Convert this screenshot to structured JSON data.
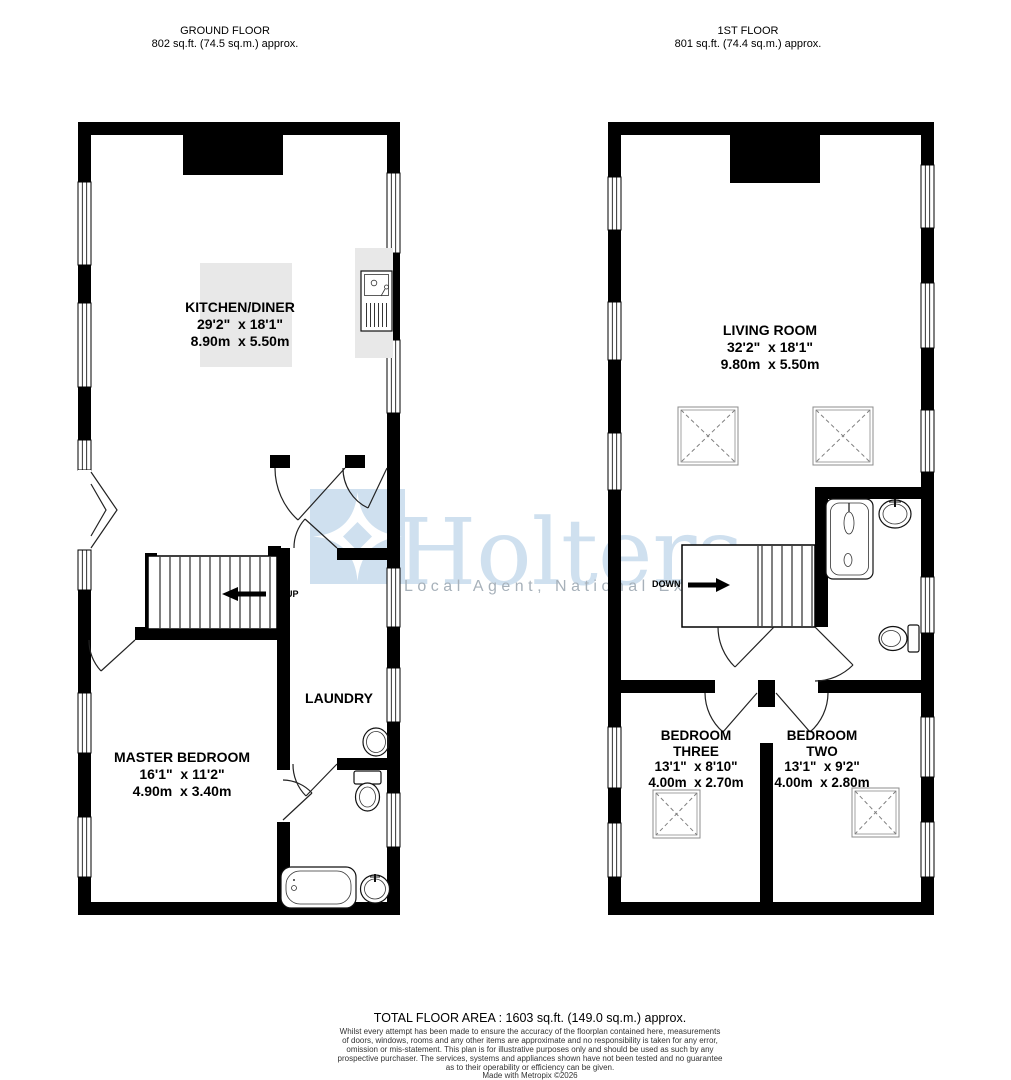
{
  "ground_floor": {
    "title": "GROUND FLOOR",
    "area": "802 sq.ft. (74.5 sq.m.) approx.",
    "kitchen": {
      "name": "KITCHEN/DINER",
      "dims_imperial": "29'2\"  x 18'1\"",
      "dims_metric": "8.90m  x 5.50m"
    },
    "master_bedroom": {
      "name": "MASTER BEDROOM",
      "dims_imperial": "16'1\"  x 11'2\"",
      "dims_metric": "4.90m  x 3.40m"
    },
    "laundry": {
      "name": "LAUNDRY"
    },
    "stairs_label": "UP"
  },
  "first_floor": {
    "title": "1ST FLOOR",
    "area": "801 sq.ft. (74.4 sq.m.) approx.",
    "living_room": {
      "name": "LIVING ROOM",
      "dims_imperial": "32'2\"  x 18'1\"",
      "dims_metric": "9.80m  x 5.50m"
    },
    "bedroom_three": {
      "name": "BEDROOM\nTHREE",
      "dims_imperial": "13'1\"  x 8'10\"",
      "dims_metric": "4.00m  x 2.70m"
    },
    "bedroom_two": {
      "name": "BEDROOM\nTWO",
      "dims_imperial": "13'1\"  x 9'2\"",
      "dims_metric": "4.00m  x 2.80m"
    },
    "stairs_label": "DOWN"
  },
  "watermark": {
    "brand": "Holters",
    "tagline": "Local Agent, National Exposure"
  },
  "footer": {
    "total_area": "TOTAL FLOOR AREA : 1603 sq.ft. (149.0 sq.m.) approx.",
    "disclaimer": "Whilst every attempt has been made to ensure the accuracy of the floorplan contained here, measurements\nof doors, windows, rooms and any other items are approximate and no responsibility is taken for any error,\nomission or mis-statement. This plan is for illustrative purposes only and should be used as such by any\nprospective purchaser. The services, systems and appliances shown have not been tested and no guarantee\nas to their operability or efficiency can be given.",
    "credit": "Made with Metropix ©2026"
  },
  "colors": {
    "wall": "#000000",
    "counter": "#e8e8e8",
    "watermark_blue": "#cfe0ef",
    "tagline_gray": "#a7b1ba"
  }
}
